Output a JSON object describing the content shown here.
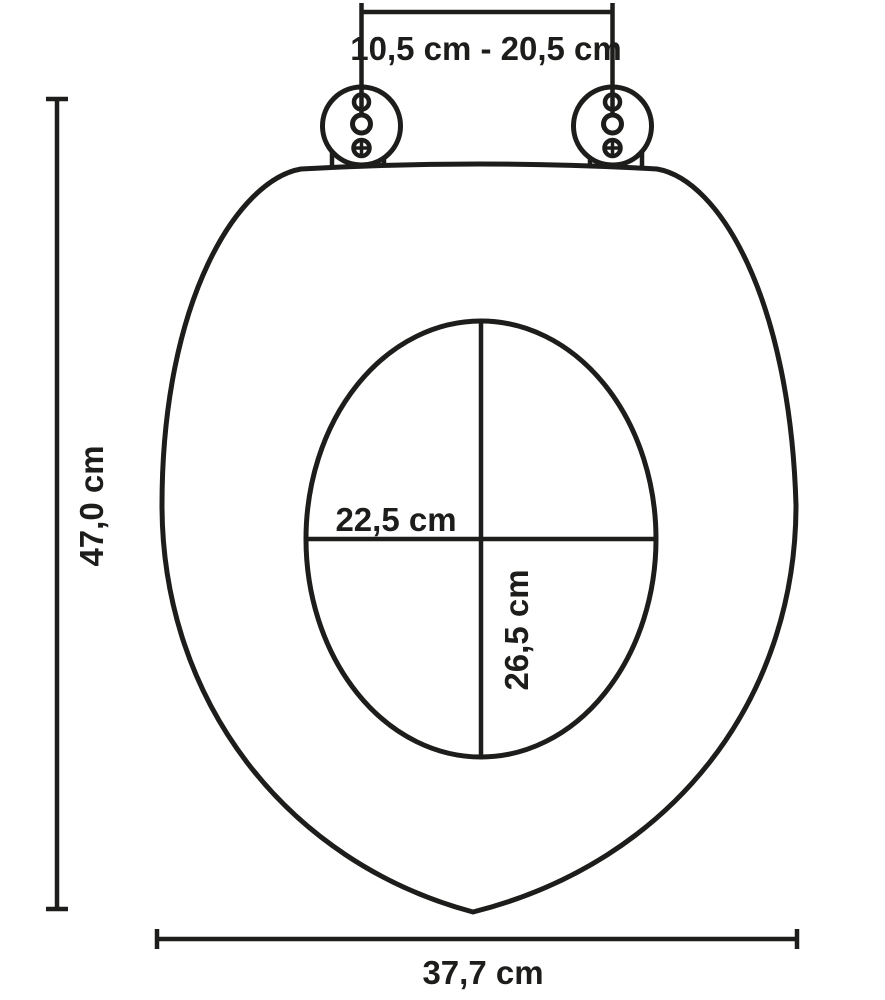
{
  "diagram": {
    "kind": "toilet-seat-dimension-drawing",
    "labels": {
      "hinge_spacing": "10,5 cm - 20,5 cm",
      "total_length": "47,0 cm",
      "inner_width": "22,5 cm",
      "inner_length": "26,5 cm",
      "outer_width": "37,7 cm"
    },
    "colors": {
      "ink": "#1d1d1b",
      "background": "#ffffff"
    }
  }
}
